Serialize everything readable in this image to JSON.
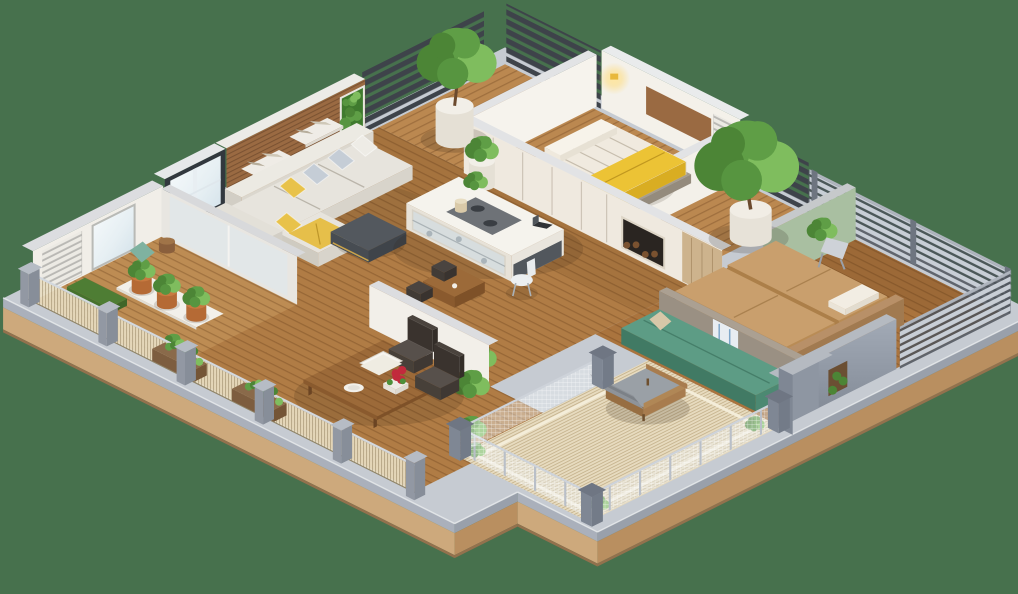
{
  "meta": {
    "title": "3D isometric apartment floor plan render",
    "background": "#47714d"
  },
  "palette": {
    "background": "#47714d",
    "slab_top": "#c6cbd2",
    "slab_gray_u": "#99a0ab",
    "slab_gray_v": "#aab0bb",
    "slab_wood_u": "#b98f60",
    "slab_wood_v": "#cda97c",
    "slab_wood_lip": "#93714d",
    "floor_wood": "#b07c45",
    "floor_wood_light": "#bb8850",
    "floor_master": "#aa743e",
    "deck_wood": "#bd8c53",
    "rug_beige": "#e7dbbf",
    "slat_rug": "#7c5a35",
    "wall_white": "#f4f1ea",
    "wall_cream": "#efe9df",
    "wall_cap": "#e2e3e5",
    "wood_wall": "#9a6a42",
    "sage_green": "#a9bfa1",
    "frame_dark": "#32383e",
    "sofa_white": "#e7e4dd",
    "pillow_blue": "#c5cdd6",
    "accent_yellow": "#e8c24a",
    "blanket_yellow": "#ecc335",
    "ottoman_dark": "#53585e",
    "bed_tan": "#c99f6d",
    "mattress_white": "#f0eadf",
    "teal": "#5d9c85",
    "concrete": "#9a9083",
    "table_wood": "#9c6a39",
    "chair_dark": "#4a433d",
    "plant_green": "#5f9e46",
    "plant_dark": "#4c8536",
    "plant_light": "#7fbd5e",
    "pot_white": "#e5e0d5",
    "pot_terracotta": "#b56a35",
    "gray_wall": "#8e96a2",
    "railing_post": "#9aa0ac",
    "mesh_beige": "rgba(232,221,194,0.92)",
    "red_flower": "#c22a3c",
    "lamp_glow": "#ffe9a8"
  },
  "scene": {
    "rooms": [
      {
        "id": "living-room",
        "objects": [
          "sectional-sofa",
          "throw-pillows",
          "yellow-throw",
          "dark-ottoman",
          "wood-accent-wall",
          "wall-shelves",
          "vertical-garden-door",
          "picture-window"
        ]
      },
      {
        "id": "kitchen",
        "objects": [
          "kitchen-island",
          "cooktop",
          "glass-cabinet",
          "white-chair",
          "laptop",
          "small-coffee-table",
          "indoor-plants"
        ]
      },
      {
        "id": "dining-area",
        "objects": [
          "dining-table",
          "dark-chairs",
          "white-plate",
          "red-roses",
          "open-book",
          "partition-wall",
          "potted-plants"
        ]
      },
      {
        "id": "bedroom-small",
        "objects": [
          "bed",
          "yellow-blanket",
          "headboard-panel",
          "glowing-wall-lamp",
          "wardrobe-wall",
          "stone-bench"
        ]
      },
      {
        "id": "bedroom-master",
        "objects": [
          "double-mattress-bed",
          "headboard",
          "slat-rug",
          "lounge-chair",
          "potted-tree",
          "sage-accent-wall",
          "sphere-lamp"
        ]
      },
      {
        "id": "terrace-patio",
        "objects": [
          "woven-rug",
          "wood-armchair",
          "teal-bench",
          "concrete-half-wall",
          "wire-railing",
          "corner-plants"
        ]
      },
      {
        "id": "balcony-left",
        "objects": [
          "wood-deck",
          "plant-tray",
          "terracotta-pots",
          "teal-cushion",
          "grass-planter",
          "tall-window",
          "white-slat-panel"
        ]
      },
      {
        "id": "balcony-right",
        "objects": [
          "horizontal-slat-railing",
          "gray-partitions",
          "plant-niche"
        ]
      },
      {
        "id": "entry-garden",
        "objects": [
          "white-planters",
          "indoor-tree",
          "dark-pergola-slats"
        ]
      }
    ]
  }
}
